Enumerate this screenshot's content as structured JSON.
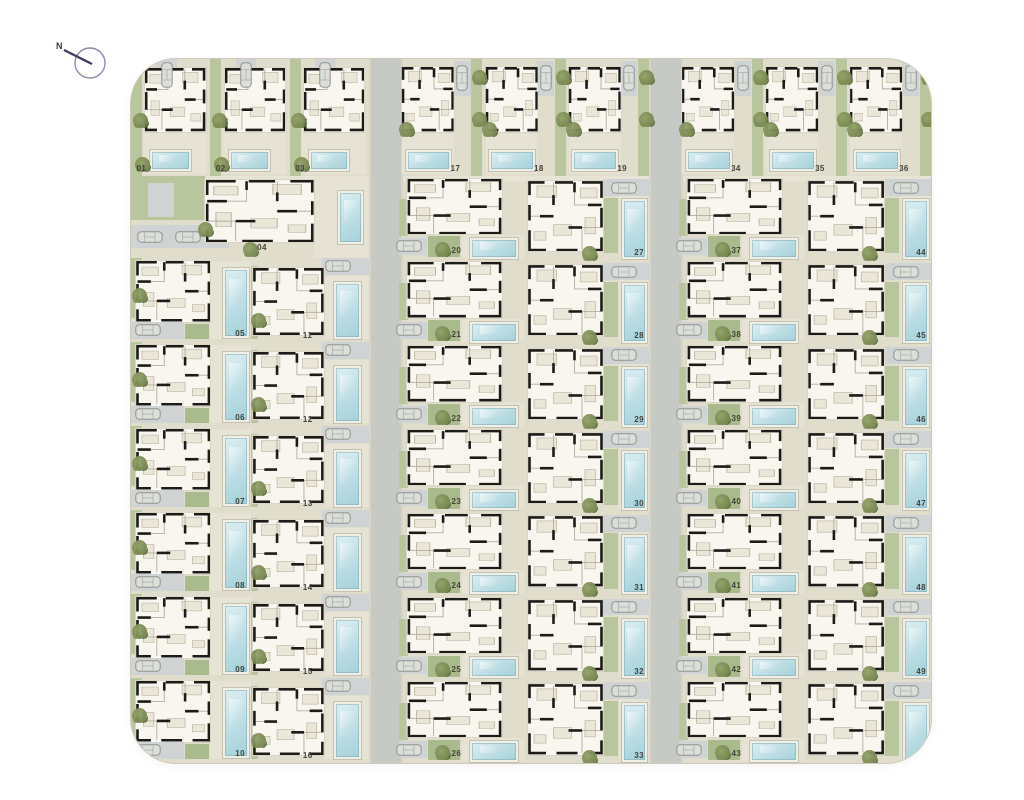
{
  "compass": {
    "label": "N"
  },
  "icons": {
    "compass": "compass-icon",
    "tree": "tree-icon",
    "car": "car-icon"
  },
  "palette": {
    "site_bg": "#e0ddcc",
    "road": "#c7c9c5",
    "garden": "#b9c59d",
    "garden_dark": "#a9ba8d",
    "pool": "#bcdde4",
    "pool_border": "#f0efe6",
    "wall": "#1d1b18",
    "plan_floor": "#f8f6ef",
    "driveway": "#cfd3d4",
    "number_text": "#45423a",
    "tree": "#75854e"
  },
  "villas": [
    {
      "number": "01",
      "zone": "top1",
      "slot": 0
    },
    {
      "number": "02",
      "zone": "top1",
      "slot": 1
    },
    {
      "number": "03",
      "zone": "top1",
      "slot": 2
    },
    {
      "number": "17",
      "zone": "top2",
      "slot": 0
    },
    {
      "number": "18",
      "zone": "top2",
      "slot": 1
    },
    {
      "number": "19",
      "zone": "top2",
      "slot": 2
    },
    {
      "number": "34",
      "zone": "top3",
      "slot": 0
    },
    {
      "number": "35",
      "zone": "top3",
      "slot": 1
    },
    {
      "number": "36",
      "zone": "top3",
      "slot": 2
    },
    {
      "number": "04",
      "zone": "A",
      "slot": 0
    },
    {
      "number": "05",
      "zone": "B",
      "slot": 0
    },
    {
      "number": "06",
      "zone": "B",
      "slot": 1
    },
    {
      "number": "07",
      "zone": "B",
      "slot": 2
    },
    {
      "number": "08",
      "zone": "B",
      "slot": 3
    },
    {
      "number": "09",
      "zone": "B",
      "slot": 4
    },
    {
      "number": "10",
      "zone": "B",
      "slot": 5
    },
    {
      "number": "11",
      "zone": "C",
      "slot": 0
    },
    {
      "number": "12",
      "zone": "C",
      "slot": 1
    },
    {
      "number": "13",
      "zone": "C",
      "slot": 2
    },
    {
      "number": "14",
      "zone": "C",
      "slot": 3
    },
    {
      "number": "15",
      "zone": "C",
      "slot": 4
    },
    {
      "number": "16",
      "zone": "C",
      "slot": 5
    },
    {
      "number": "20",
      "zone": "D",
      "slot": 0
    },
    {
      "number": "21",
      "zone": "D",
      "slot": 1
    },
    {
      "number": "22",
      "zone": "D",
      "slot": 2
    },
    {
      "number": "23",
      "zone": "D",
      "slot": 3
    },
    {
      "number": "24",
      "zone": "D",
      "slot": 4
    },
    {
      "number": "25",
      "zone": "D",
      "slot": 5
    },
    {
      "number": "26",
      "zone": "D",
      "slot": 6
    },
    {
      "number": "27",
      "zone": "E",
      "slot": 0
    },
    {
      "number": "28",
      "zone": "E",
      "slot": 1
    },
    {
      "number": "29",
      "zone": "E",
      "slot": 2
    },
    {
      "number": "30",
      "zone": "E",
      "slot": 3
    },
    {
      "number": "31",
      "zone": "E",
      "slot": 4
    },
    {
      "number": "32",
      "zone": "E",
      "slot": 5
    },
    {
      "number": "33",
      "zone": "E",
      "slot": 6
    },
    {
      "number": "37",
      "zone": "F",
      "slot": 0
    },
    {
      "number": "38",
      "zone": "F",
      "slot": 1
    },
    {
      "number": "39",
      "zone": "F",
      "slot": 2
    },
    {
      "number": "40",
      "zone": "F",
      "slot": 3
    },
    {
      "number": "41",
      "zone": "F",
      "slot": 4
    },
    {
      "number": "42",
      "zone": "F",
      "slot": 5
    },
    {
      "number": "43",
      "zone": "F",
      "slot": 6
    },
    {
      "number": "44",
      "zone": "G",
      "slot": 0
    },
    {
      "number": "45",
      "zone": "G",
      "slot": 1
    },
    {
      "number": "46",
      "zone": "G",
      "slot": 2
    },
    {
      "number": "47",
      "zone": "G",
      "slot": 3
    },
    {
      "number": "48",
      "zone": "G",
      "slot": 4
    },
    {
      "number": "49",
      "zone": "G",
      "slot": 5
    },
    {
      "number": "50",
      "zone": "G",
      "slot": 6
    }
  ]
}
